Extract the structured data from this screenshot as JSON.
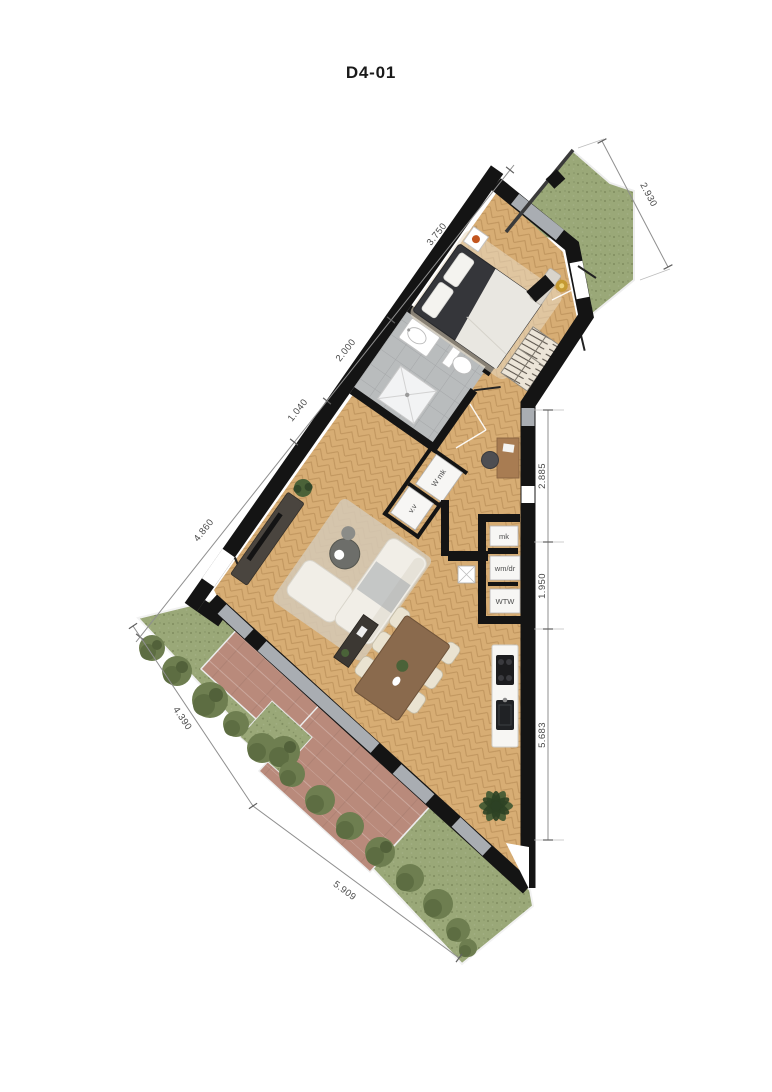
{
  "title": "D4-01",
  "dimensions": {
    "top_chain": [
      {
        "label": "4.860"
      },
      {
        "label": "1.040"
      },
      {
        "label": "2.000"
      },
      {
        "label": "3.750"
      }
    ],
    "balcony": {
      "label": "2.930"
    },
    "right_chain": [
      {
        "label": "2.885"
      },
      {
        "label": "1.950"
      },
      {
        "label": "5.683"
      }
    ],
    "garden_chain": [
      {
        "label": "4.390"
      },
      {
        "label": "5.909"
      }
    ]
  },
  "closets": {
    "vv": "v.v",
    "wmk": "W mk",
    "mk": "mk",
    "wmdr": "wm/dr",
    "wtw": "WTW"
  },
  "colors": {
    "wall": "#141414",
    "wood": "#d7ad74",
    "tile": "#b9bcbd",
    "glass": "#a9adb2",
    "grass": "#9aa878",
    "bush": "#6e7e50",
    "terrace": "#b98a7b",
    "dim": "#8f8f8f",
    "dimtext": "#4a4a4a",
    "cream": "#f1eee7",
    "darkfurn": "#4a453f",
    "bedframe": "#35363a",
    "woodfurn": "#8a6a4d",
    "counter": "#f7f6f3",
    "appliance": "#1c1c1e",
    "plant": "#4a6238",
    "plantdark": "#33482a",
    "orange": "#c2551f",
    "rug": "#d5c9b6",
    "gold": "#c59a33",
    "title": "#1a1a1a"
  }
}
